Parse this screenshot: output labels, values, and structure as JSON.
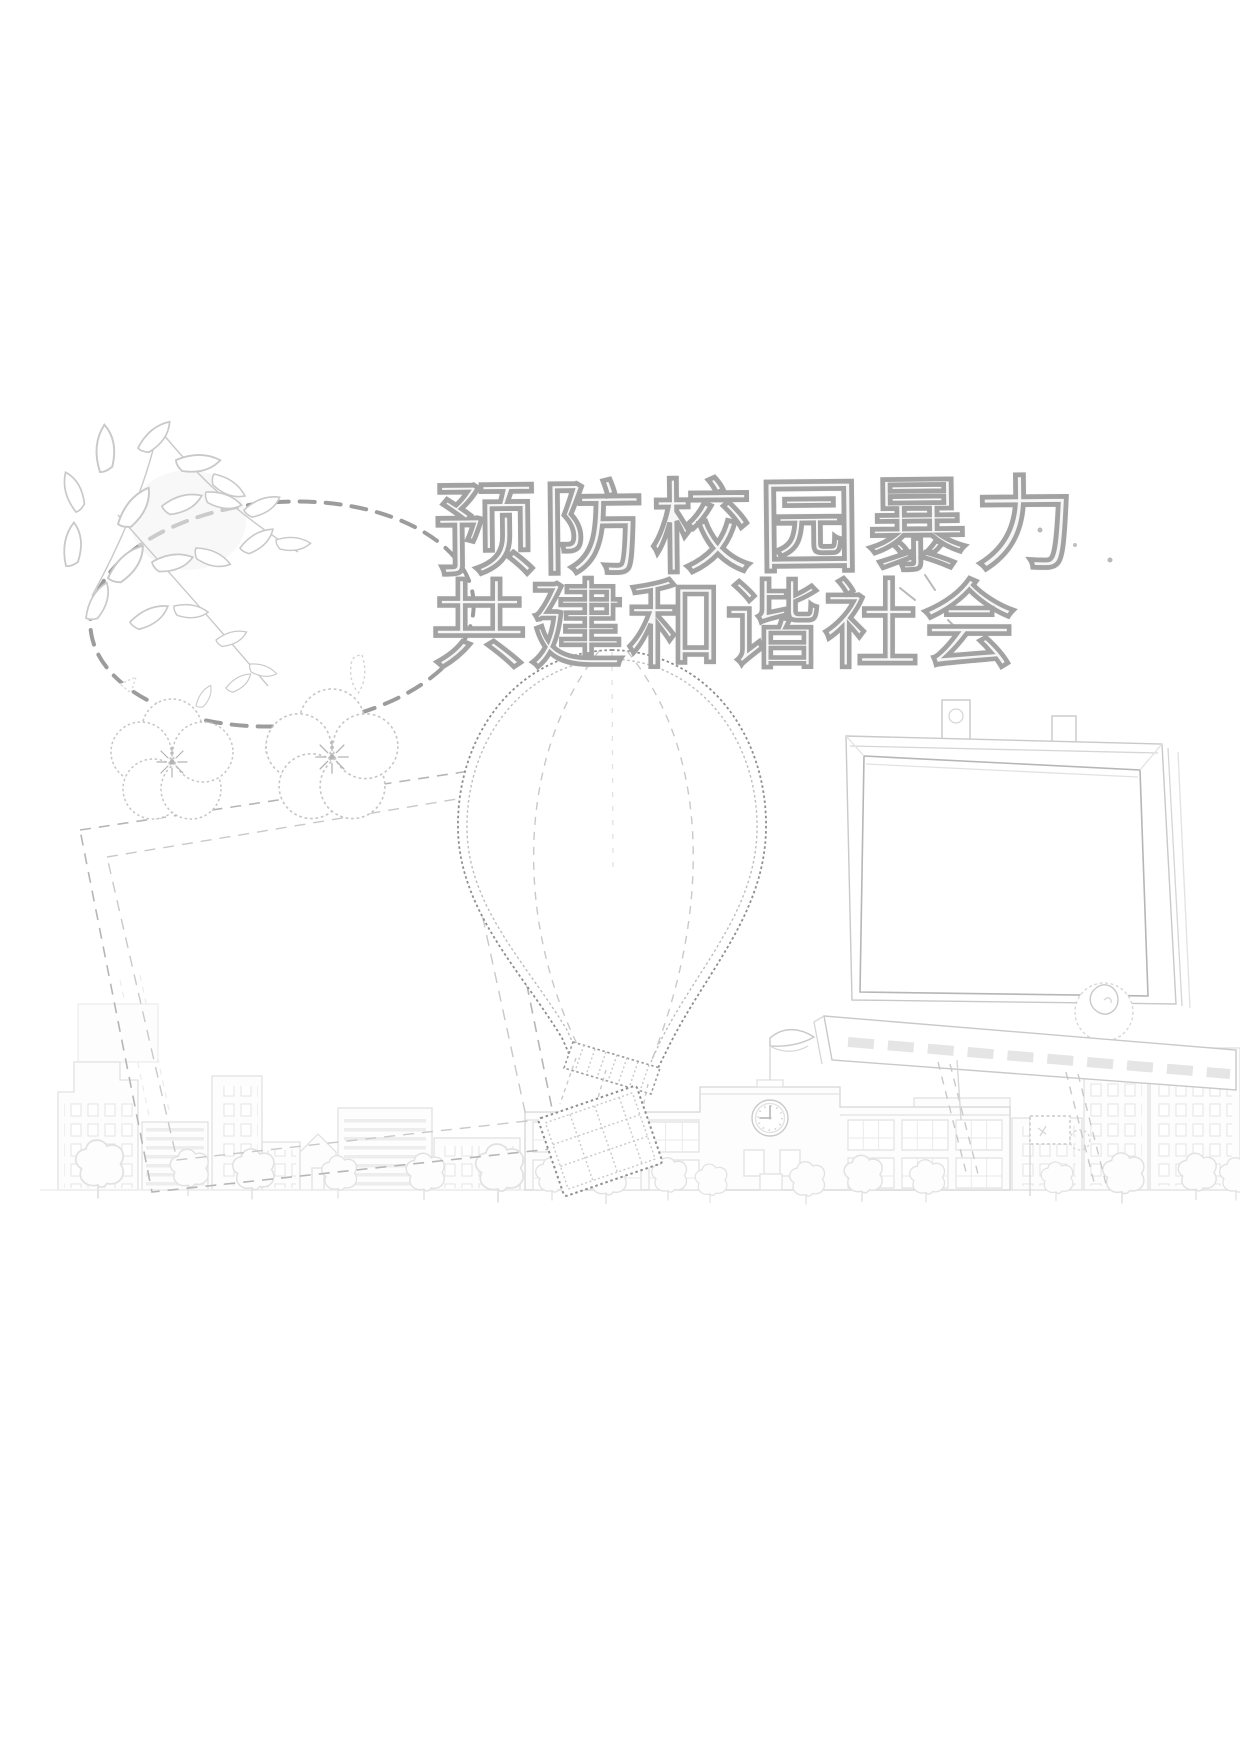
{
  "poster": {
    "background_color": "#ffffff",
    "title": {
      "line1": "预防校园暴力",
      "line2": "共建和谐社会",
      "style": "hollow outline calligraphy",
      "outline_color": "#9e9e9e"
    },
    "content_frames": [
      {
        "name": "dashed-cloud-frame",
        "text": ""
      },
      {
        "name": "left-tilted-frame",
        "text": ""
      },
      {
        "name": "hot-air-balloon-frame",
        "text": ""
      },
      {
        "name": "easel-board-frame",
        "text": ""
      }
    ],
    "school": {
      "clock_time": "9:00"
    },
    "decorations": [
      "branch-with-leaves",
      "plum-blossom-flowers",
      "falling-leaves",
      "hot-air-balloon",
      "balloon-basket",
      "easel-board",
      "board-tray",
      "board-legs",
      "circle-doodle",
      "school-building",
      "school-clock",
      "wavy-flag",
      "small-dotted-flag",
      "city-skyline",
      "trees",
      "ink-splashes"
    ],
    "palette": {
      "faint": "#e8e8e8",
      "light": "#cfcfcf",
      "mid": "#b2b2b2",
      "dark": "#8f8f8f",
      "cloud_dash": "#9c9c9c"
    }
  }
}
